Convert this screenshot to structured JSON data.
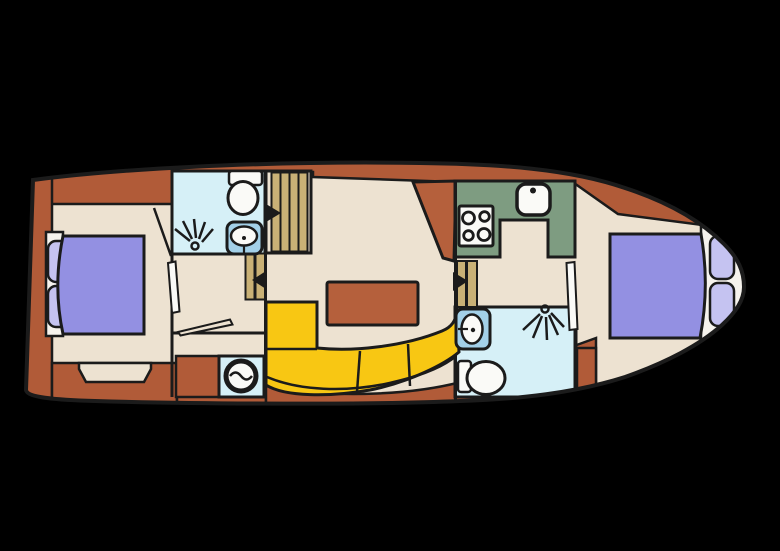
{
  "scene": {
    "type": "boat-floor-plan",
    "description": "Top-down deck plan of a motor yacht, bow pointing right",
    "background": "#000000"
  },
  "colors": {
    "background": "#000000",
    "outline": "#1b1b1b",
    "deck": "#b15b38",
    "deckAccent": "#b5603c",
    "floor": "#ede2d1",
    "bathFloor": "#d6f0f7",
    "galley": "#7e9c81",
    "sofa": "#f8c713",
    "bed": "#9390e2",
    "pillow": "#c5c3f1",
    "bolster": "#f6f3ed",
    "stair": "#c9b176",
    "sinkBlue": "#a3d0e8",
    "fixture": "#fafaf7"
  },
  "legend": {
    "rooms": [
      {
        "name": "Aft cabin with double bed"
      },
      {
        "name": "Aft bathroom with toilet, washbasin and shower"
      },
      {
        "name": "Corridor with washing machine"
      },
      {
        "name": "Saloon with table and curved sofa"
      },
      {
        "name": "Galley with stove and sink"
      },
      {
        "name": "Forward bathroom with toilet, washbasin and shower"
      },
      {
        "name": "Bow cabin with double bed"
      }
    ],
    "icons": [
      "toilet-icon",
      "washbasin-icon",
      "shower-spray-icon",
      "washing-machine-icon",
      "stove-icon",
      "kitchen-sink-icon",
      "double-bed-icon",
      "pillow-icon",
      "sofa-icon",
      "table-icon",
      "stairs-icon",
      "direction-arrow-icon",
      "door-leaf-icon"
    ]
  }
}
